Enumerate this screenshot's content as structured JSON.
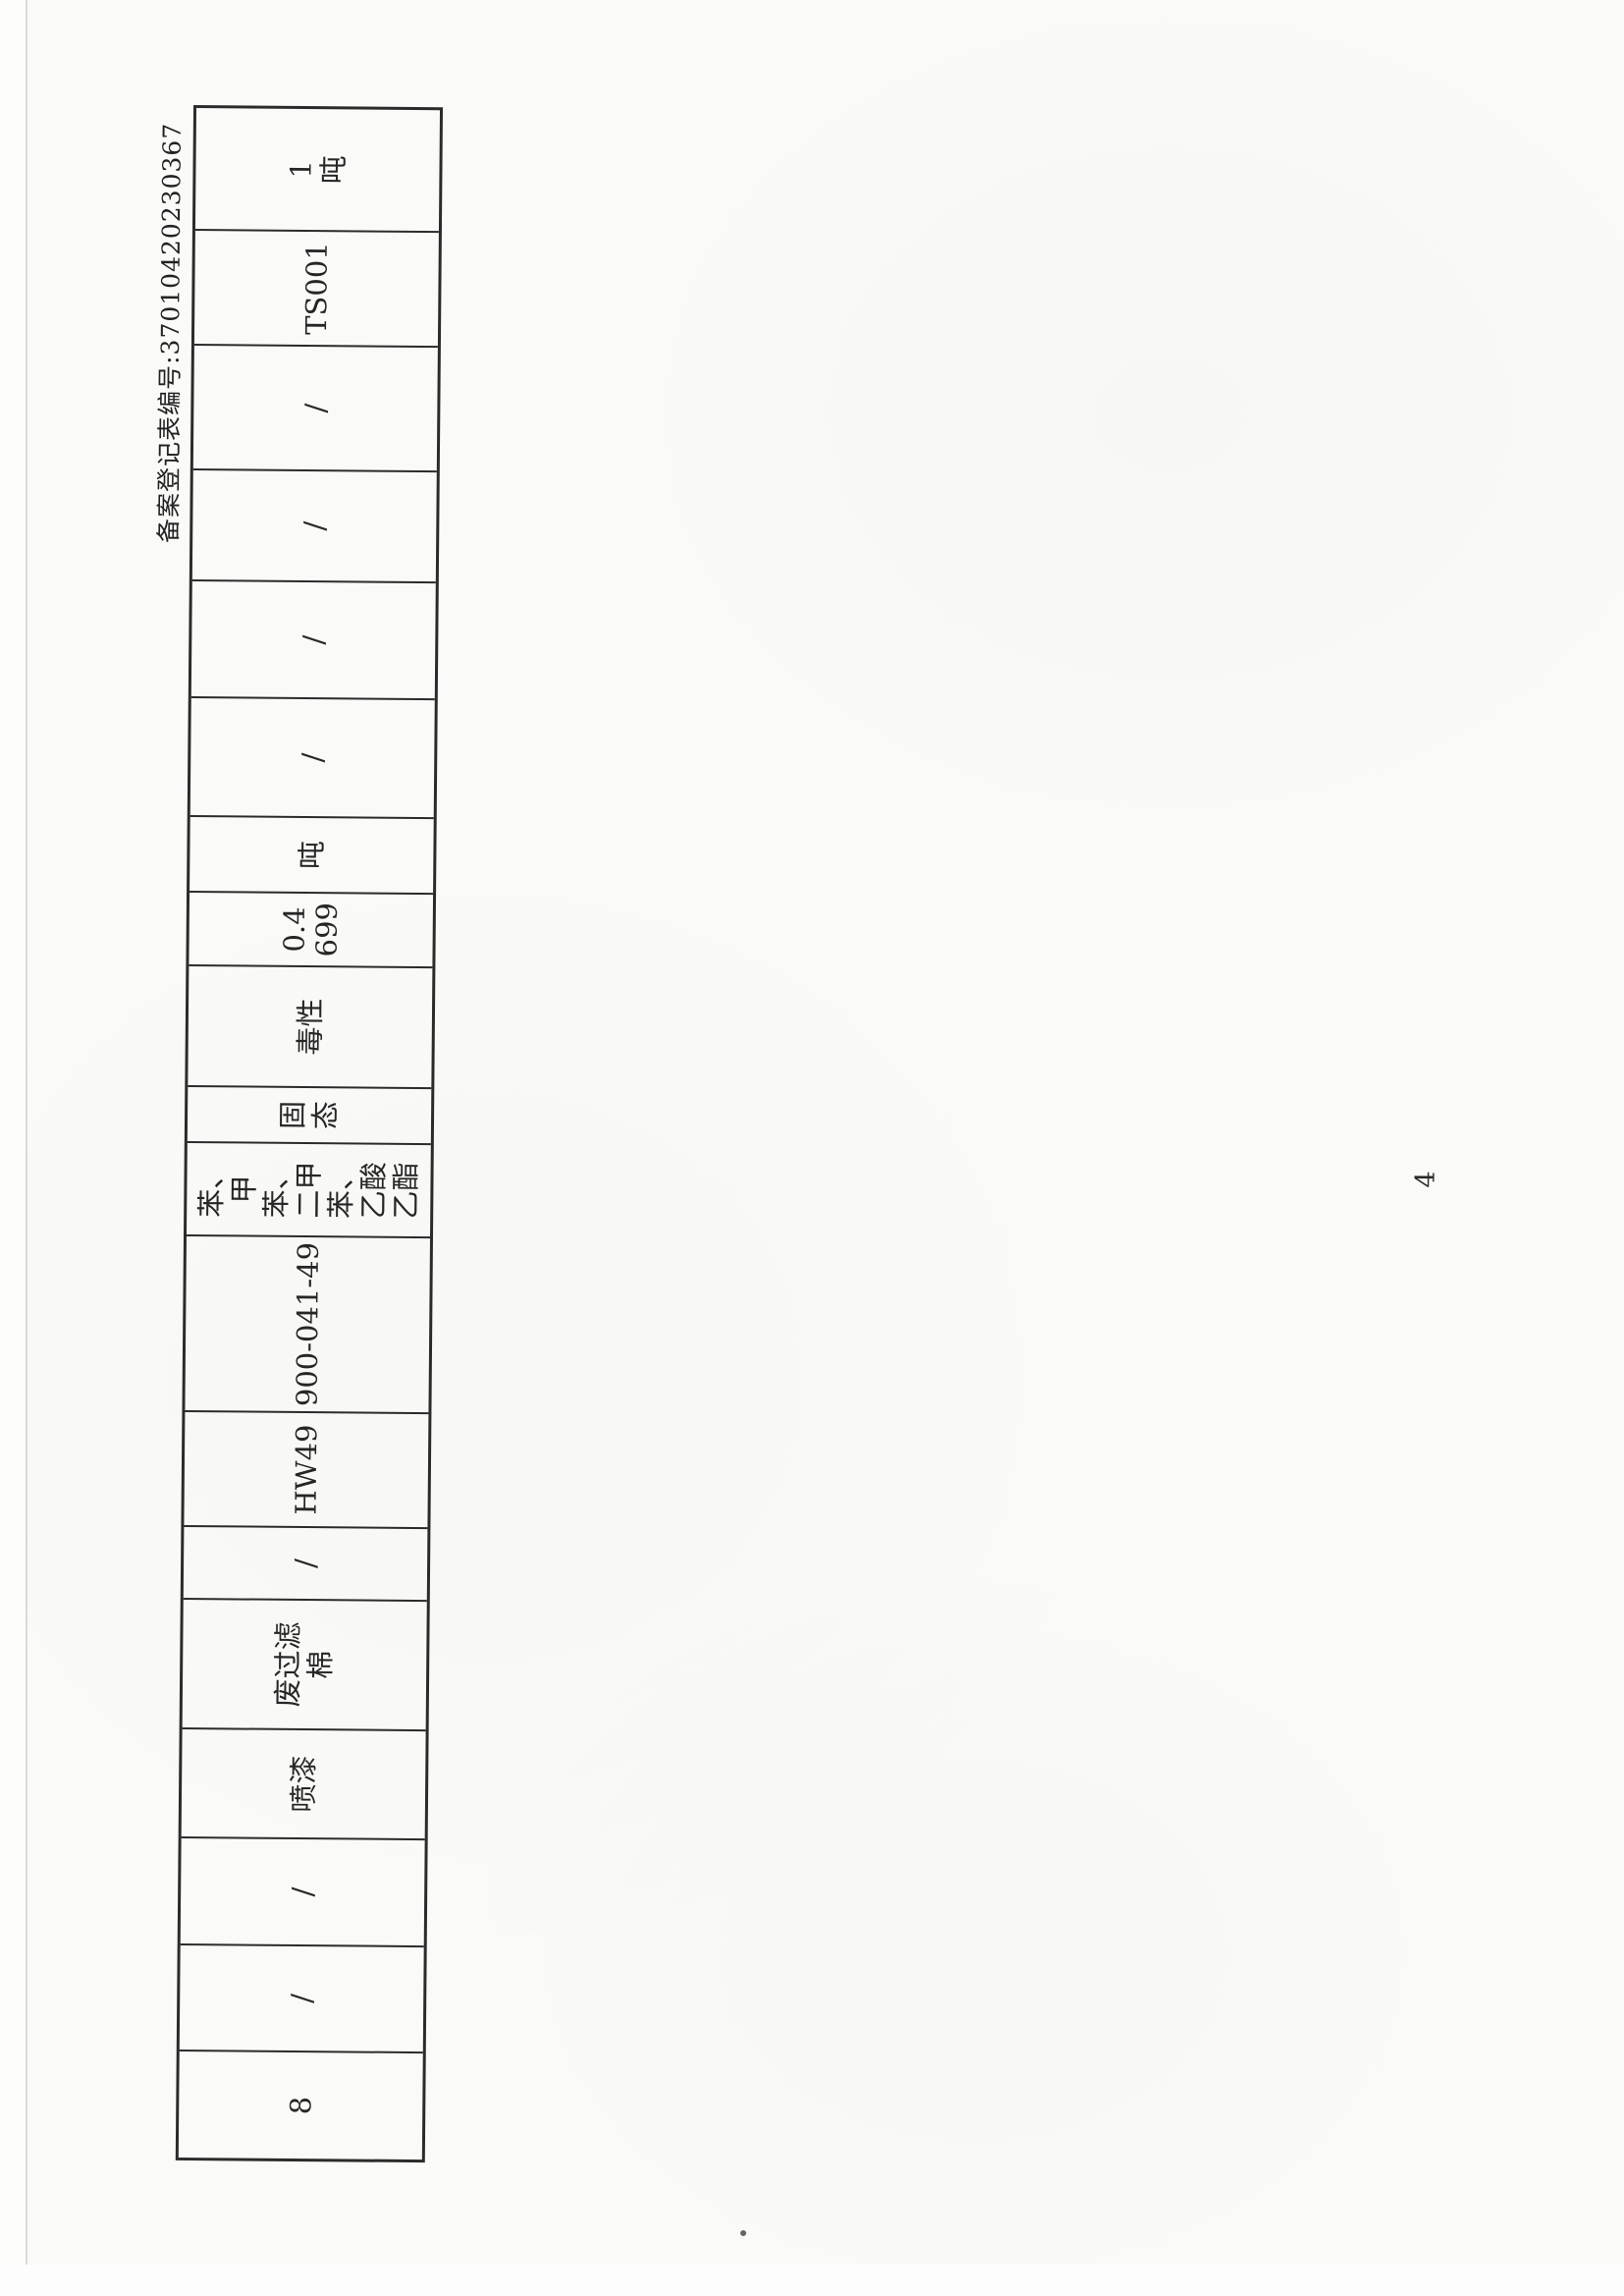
{
  "page": {
    "paper_color": "#fafaf8",
    "ink_color": "#262626",
    "table_border_color": "#2b2b2b"
  },
  "header": {
    "form_number": "备案登记表编号:37010420230367"
  },
  "table": {
    "orientation": "rotated-90-counterclockwise",
    "cells": [
      {
        "text": "8"
      },
      {
        "text": "/"
      },
      {
        "text": "/"
      },
      {
        "text": "喷漆"
      },
      {
        "text": "废过滤\n棉"
      },
      {
        "text": "/"
      },
      {
        "text": "HW49"
      },
      {
        "text": "900-041-49"
      },
      {
        "text": "苯、\n甲\n苯、\n二甲\n苯、\n乙酸\n乙酯"
      },
      {
        "text": "固\n态"
      },
      {
        "text": "毒性"
      },
      {
        "text": "0.4\n699"
      },
      {
        "text": "吨"
      },
      {
        "text": "/"
      },
      {
        "text": "/"
      },
      {
        "text": "/"
      },
      {
        "text": "/"
      },
      {
        "text": "TS001"
      },
      {
        "text": "1\n吨"
      }
    ]
  },
  "footer": {
    "page_number": "4"
  }
}
